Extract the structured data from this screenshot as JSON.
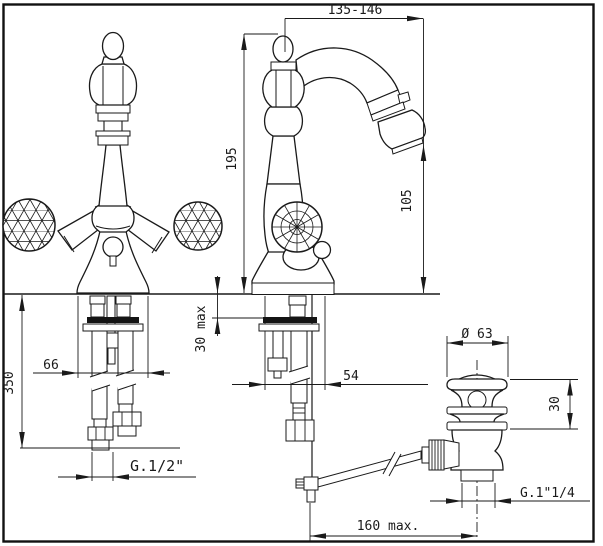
{
  "drawing": {
    "title": "bidet mixer tap technical drawing",
    "type": "dimensioned technical drawing, front view / side view / pop-up waste detail",
    "colors": {
      "line": "#1a1a1a",
      "background": "#ffffff"
    },
    "dimensions": {
      "spout_reach": "135-146",
      "total_height": "195",
      "outlet_height": "105",
      "max_deck_thickness": "30 max",
      "hose_length": "350",
      "base_width": "66",
      "base_depth": "54",
      "supply_thread": "G.1/2\"",
      "waste_flange_diameter": "Ø 63",
      "waste_top_height": "30",
      "waste_thread": "G.1\"1/4",
      "rod_max_reach": "160 max."
    }
  }
}
